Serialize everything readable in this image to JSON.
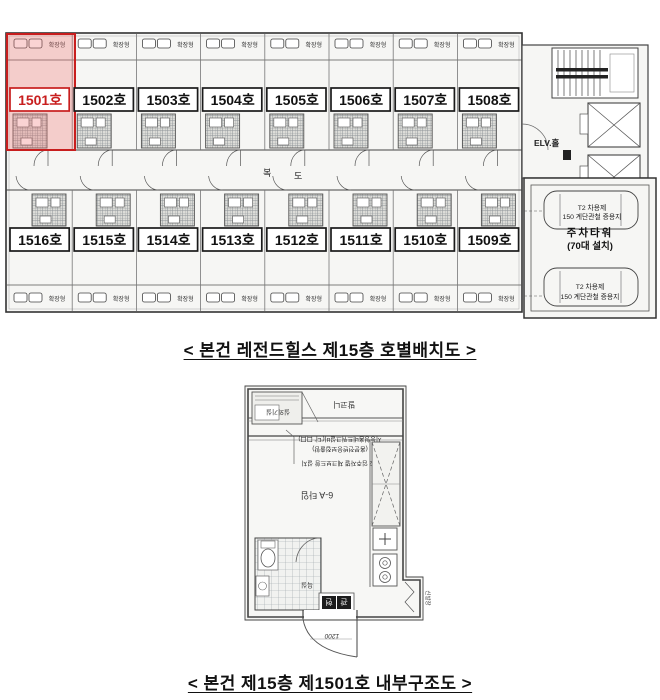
{
  "floor_plan": {
    "caption": "< 본건 레전드힐스 제15층 호별배치도 >",
    "strip_label": "확장형",
    "corridor_label_1": "복",
    "corridor_label_2": "도",
    "elevator_label": "ELV.홀",
    "highlight_color": "#c81e1e",
    "highlight_fill": "rgba(238,110,110,0.30)",
    "row1_units": [
      {
        "label": "1501호",
        "highlight": true
      },
      {
        "label": "1502호",
        "highlight": false
      },
      {
        "label": "1503호",
        "highlight": false
      },
      {
        "label": "1504호",
        "highlight": false
      },
      {
        "label": "1505호",
        "highlight": false
      },
      {
        "label": "1506호",
        "highlight": false
      },
      {
        "label": "1507호",
        "highlight": false
      },
      {
        "label": "1508호",
        "highlight": false
      }
    ],
    "row2_units": [
      {
        "label": "1516호",
        "highlight": false
      },
      {
        "label": "1515호",
        "highlight": false
      },
      {
        "label": "1514호",
        "highlight": false
      },
      {
        "label": "1513호",
        "highlight": false
      },
      {
        "label": "1512호",
        "highlight": false
      },
      {
        "label": "1511호",
        "highlight": false
      },
      {
        "label": "1510호",
        "highlight": false
      },
      {
        "label": "1509호",
        "highlight": false
      }
    ],
    "parking": {
      "title_line1": "주차타워",
      "title_line2": "(70대 설치)",
      "note_top": [
        "T2 차용제",
        "150 계단관철 증용지"
      ],
      "note_bottom": [
        "T2 차용제",
        "150 계단관철 증용지"
      ]
    }
  },
  "unit_plan": {
    "caption": "< 본건 제15층 제1501호 내부구조도 >",
    "labels": {
      "balcony": "발코니",
      "outdoor_unit_room": "실외기실",
      "room_type": "6-A 타입",
      "bathroom": "욕실",
      "entrance_char_1": "현",
      "entrance_char_2": "관",
      "shoe_closet": "신발장",
      "door_width": "1200",
      "note_line1": "지능형홈네트워크설비('디' 口口)",
      "note_line2": "(홈분전반응보접출함)",
      "note_line3": "T/2 입주자별 체크보드함 설치"
    }
  }
}
